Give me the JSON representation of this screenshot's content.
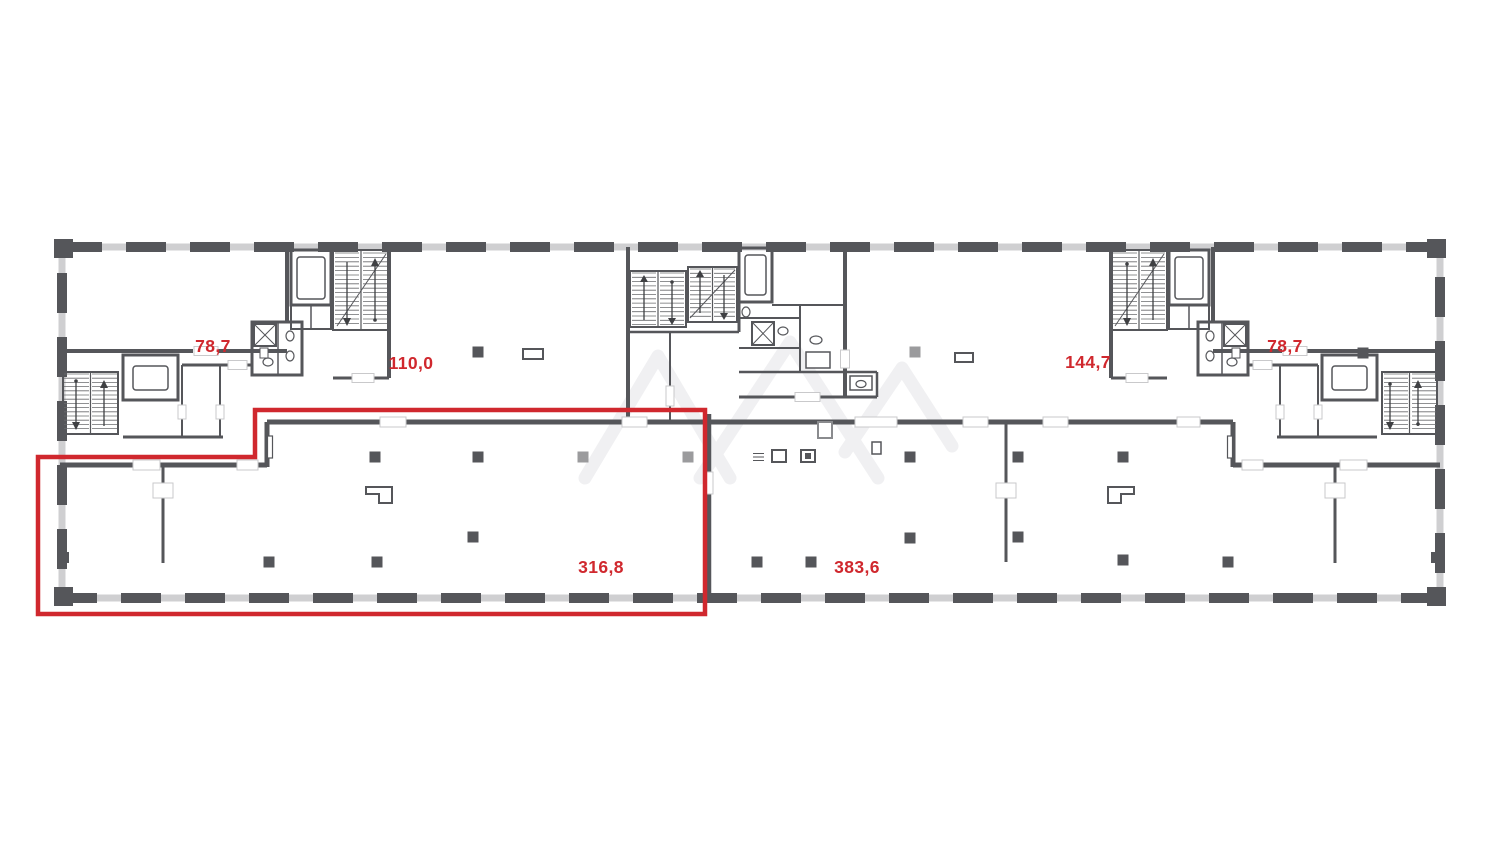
{
  "canvas": {
    "background": "#ffffff"
  },
  "palette": {
    "wall": "#55565a",
    "window_gap": "#cfcfd1",
    "column_gray": "#9b9b9d",
    "accent_red": "#d0282e",
    "watermark": "#f0f0f2"
  },
  "plan": {
    "type": "office-building-floor-plan",
    "watermark_icon": "faint-diagonal-peaks-watermark",
    "highlight": {
      "outline_color": "#d0282e",
      "highlighted_unit": "316,8"
    }
  },
  "units": [
    {
      "name": "unit-left",
      "area_label": "78,7"
    },
    {
      "name": "unit-left-center",
      "area_label": "110,0"
    },
    {
      "name": "unit-right-center",
      "area_label": "144,7"
    },
    {
      "name": "unit-right",
      "area_label": "78,7"
    },
    {
      "name": "hall-left",
      "area_label": "316,8",
      "highlighted": true
    },
    {
      "name": "hall-right",
      "area_label": "383,6"
    }
  ]
}
